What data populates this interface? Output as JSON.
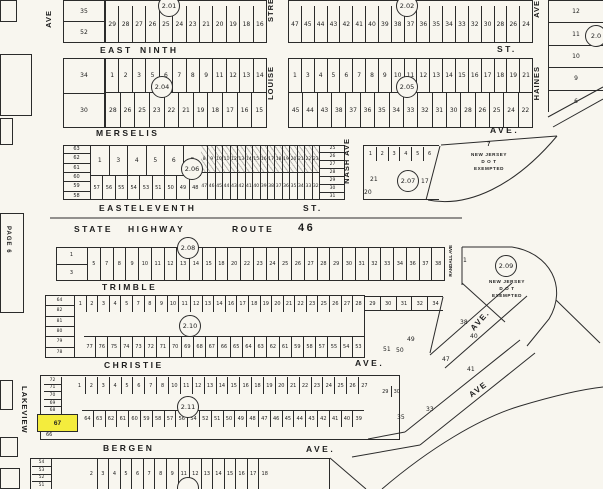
{
  "colors": {
    "paper": "#f8f6ef",
    "ink": "#2b2b2b",
    "highlight": "#f4ec3d"
  },
  "streets": {
    "east_ninth": {
      "p1": "EAST",
      "p2": "NINTH",
      "p3": "ST."
    },
    "merselis": {
      "p1": "MERSELIS",
      "p2": "AVE."
    },
    "east_eleventh": {
      "p1": "EAST",
      "p2": "ELEVENTH",
      "p3": "ST."
    },
    "route46": {
      "p1": "STATE",
      "p2": "HIGHWAY",
      "p3": "ROUTE",
      "p4": "46"
    },
    "trimble": {
      "p1": "TRIMBLE"
    },
    "christie": {
      "p1": "CHRISTIE",
      "p2": "AVE."
    },
    "bergen": {
      "p1": "BERGEN",
      "p2": "AVE."
    },
    "louise": {
      "top": "STRE",
      "name": "LOUISE"
    },
    "nash": {
      "name": "NASH AVE"
    },
    "haines": {
      "top": "AVE",
      "name": "HAINES"
    },
    "randall": {
      "name": "RANDALL AVE"
    },
    "lakeview": {
      "name": "LAKEVIEW"
    },
    "ave_topleft": {
      "name": "AVE"
    },
    "page_label": {
      "name": "PAGE 6"
    },
    "diag_ave_upper": {
      "name": "AVE."
    },
    "diag_ave_lower": {
      "name": "AVE"
    }
  },
  "circles": {
    "c201": "2.01",
    "c202": "2.02",
    "c203": "2.0",
    "c204": "2.04",
    "c205": "2.05",
    "c206": "2.06",
    "c207": "2.07",
    "c208": "2.08",
    "c209": "2.09",
    "c210": "2.10",
    "c211": "2.11"
  },
  "njdot": {
    "lot7": "7",
    "lot1": "1",
    "lines": [
      "NEW  JERSEY",
      "D O T",
      "EXEMPTED"
    ]
  },
  "lots": {
    "nw_top": [
      "35",
      "52"
    ],
    "nw_mid": [
      "34",
      "30"
    ],
    "b201_row": [
      "29",
      "28",
      "27",
      "26",
      "25",
      "24",
      "23",
      "21",
      "20",
      "19",
      "18",
      "16"
    ],
    "b202_row": [
      "47",
      "45",
      "44",
      "43",
      "42",
      "41",
      "40",
      "39",
      "38",
      "37",
      "36",
      "35",
      "34",
      "33",
      "32",
      "30",
      "28",
      "26",
      "24"
    ],
    "b203_col": [
      "12",
      "11",
      "10",
      "9",
      "6"
    ],
    "b204_top": [
      "1",
      "2",
      "3",
      "5",
      "6",
      "7",
      "8",
      "9",
      "11",
      "12",
      "13",
      "14"
    ],
    "b204_bottom": [
      "28",
      "26",
      "25",
      "23",
      "22",
      "21",
      "19",
      "18",
      "17",
      "16",
      "15"
    ],
    "b205_top": [
      "1",
      "3",
      "4",
      "5",
      "6",
      "7",
      "8",
      "9",
      "10",
      "11",
      "12",
      "13",
      "14",
      "15",
      "16",
      "17",
      "18",
      "19",
      "21"
    ],
    "b205_bottom": [
      "45",
      "44",
      "43",
      "38",
      "37",
      "36",
      "35",
      "34",
      "33",
      "32",
      "31",
      "30",
      "28",
      "26",
      "25",
      "24",
      "22"
    ],
    "b206_left": [
      "63",
      "62",
      "61",
      "60",
      "59",
      "58"
    ],
    "b206_top_a": [
      "1",
      "3",
      "4",
      "5",
      "6",
      "7"
    ],
    "b206_top_b": [
      "8",
      "9",
      "10",
      "11",
      "12",
      "13",
      "14",
      "15",
      "16",
      "17",
      "18",
      "19",
      "20",
      "21",
      "22",
      "23"
    ],
    "b206_bottom_a": [
      "57",
      "56",
      "55",
      "54",
      "53",
      "51",
      "50",
      "49",
      "48"
    ],
    "b206_bottom_b": [
      "47",
      "46",
      "45",
      "44",
      "43",
      "42",
      "41",
      "40",
      "39",
      "38",
      "37",
      "36",
      "35",
      "34",
      "33",
      "32"
    ],
    "b206_right": [
      "25",
      "26",
      "27",
      "28",
      "29",
      "30",
      "31"
    ],
    "b207_top": [
      "1",
      "2",
      "3",
      "4",
      "5",
      "6"
    ],
    "b207_others": [
      "21",
      "20",
      "17"
    ],
    "b208_left": [
      "1",
      "3"
    ],
    "b208_row": [
      "5",
      "7",
      "8",
      "9",
      "10",
      "11",
      "12",
      "13",
      "14",
      "15",
      "18",
      "20",
      "22",
      "23",
      "24",
      "25",
      "26",
      "27",
      "28",
      "29",
      "30",
      "31",
      "32",
      "33",
      "34",
      "36",
      "37",
      "38"
    ],
    "b209_lot": "1",
    "b210_left": [
      "64",
      "82",
      "81",
      "80",
      "79",
      "78"
    ],
    "b210_top": [
      "1",
      "2",
      "3",
      "4",
      "5",
      "7",
      "8",
      "9",
      "10",
      "11",
      "12",
      "13",
      "14",
      "16",
      "17",
      "18",
      "19",
      "20",
      "21",
      "22",
      "23",
      "25",
      "26",
      "27",
      "28"
    ],
    "b210_top_ext": [
      "29",
      "30",
      "31",
      "32",
      "34"
    ],
    "b210_bottom": [
      "77",
      "76",
      "75",
      "74",
      "73",
      "72",
      "71",
      "70",
      "69",
      "68",
      "67",
      "66",
      "65",
      "64",
      "63",
      "62",
      "61",
      "59",
      "58",
      "57",
      "55",
      "54",
      "53"
    ],
    "b211_left": [
      "72",
      "71",
      "70",
      "69",
      "68"
    ],
    "b211_top": [
      "1",
      "2",
      "3",
      "4",
      "5",
      "6",
      "7",
      "8",
      "10",
      "11",
      "12",
      "13",
      "14",
      "15",
      "16",
      "18",
      "19",
      "20",
      "21",
      "22",
      "23",
      "24",
      "25",
      "26",
      "27"
    ],
    "b211_bottom": [
      "64",
      "63",
      "62",
      "61",
      "60",
      "59",
      "58",
      "57",
      "56",
      "54",
      "52",
      "51",
      "50",
      "49",
      "48",
      "47",
      "46",
      "45",
      "44",
      "43",
      "42",
      "41",
      "40",
      "39"
    ],
    "b211_right": [
      "29",
      "30"
    ],
    "b212_left": [
      "54",
      "53",
      "52",
      "51"
    ],
    "b212_row": [
      "2",
      "3",
      "4",
      "5",
      "6",
      "7",
      "8",
      "9",
      "11",
      "12",
      "13",
      "14",
      "15",
      "16",
      "17",
      "18"
    ],
    "diag": [
      "49",
      "51",
      "50",
      "38",
      "40",
      "47",
      "41",
      "35",
      "33"
    ]
  },
  "highlight": {
    "lot": "67",
    "below": "66"
  }
}
